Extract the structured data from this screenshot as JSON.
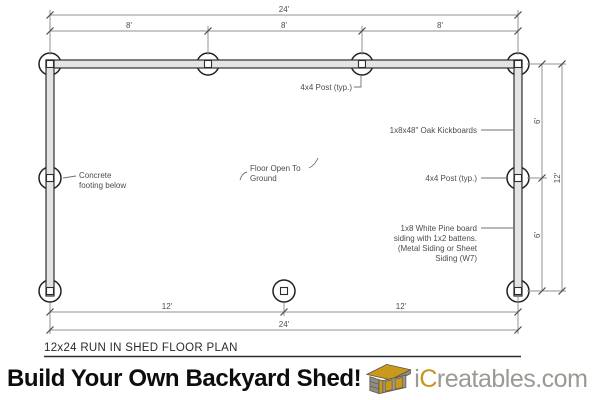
{
  "plan": {
    "title": "12x24 RUN IN SHED FLOOR PLAN",
    "dims": {
      "top_total": "24'",
      "top_seg_1": "8'",
      "top_seg_2": "8'",
      "top_seg_3": "8'",
      "right_seg_1": "6'",
      "right_seg_2": "6'",
      "right_total": "12'",
      "bottom_seg_1": "12'",
      "bottom_seg_2": "12'",
      "bottom_total": "24'"
    },
    "labels": {
      "post_top": "4x4 Post (typ.)",
      "kickboards": "1x8x48\" Oak Kickboards",
      "post_right": "4x4 Post (typ.)",
      "siding_1": "1x8 White Pine board",
      "siding_2": "siding with 1x2 battens.",
      "siding_3": "(Metal Siding or Sheet",
      "siding_4": "Siding (W7)",
      "footing_1": "Concrete",
      "footing_2": "footing below",
      "floor_1": "Floor Open To",
      "floor_2": "Ground"
    }
  },
  "banner": {
    "headline": "Build Your Own Backyard Shed!",
    "brand_i": "i",
    "brand_c": "C",
    "brand_rest": "reatables.com"
  },
  "colors": {
    "brand_gold": "#C7941C",
    "brand_gray": "#9A9A92",
    "wall_fill": "#E4E4E2",
    "line_gray": "#909090",
    "drawing_text": "#4C4C4C"
  }
}
